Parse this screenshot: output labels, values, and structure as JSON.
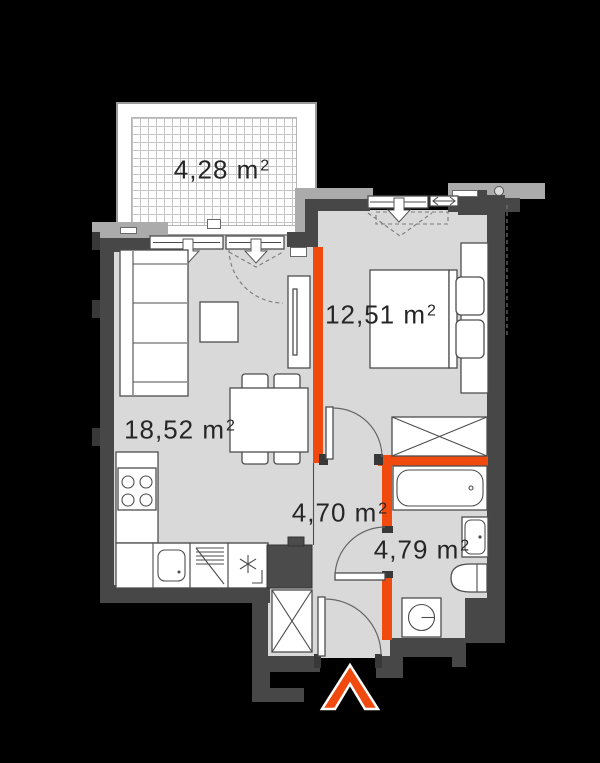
{
  "plan_type": "apartment-floor-plan",
  "rooms": [
    {
      "id": "living-kitchen",
      "area_label": "18,52 m",
      "sup": "2"
    },
    {
      "id": "bedroom",
      "area_label": "12,51 m",
      "sup": "2"
    },
    {
      "id": "balcony",
      "area_label": "4,28 m",
      "sup": "2"
    },
    {
      "id": "hallway",
      "area_label": "4,70 m",
      "sup": "2"
    },
    {
      "id": "bathroom",
      "area_label": "4,79 m",
      "sup": "2"
    }
  ],
  "colors": {
    "background": "#000000",
    "floor": "#D9D9D9",
    "wall_dark": "#474747",
    "wall_light": "#ABABAB",
    "accent_orange": "#F04A0F",
    "outline": "#4D4D4D",
    "label_text": "#262626",
    "balcony_grid": "#C4C4C4"
  },
  "symbols": [
    "sofa",
    "coffee-table",
    "tv-cabinet",
    "dining-table",
    "chair",
    "kitchen-counter",
    "cooktop",
    "kitchen-sink",
    "dishwasher",
    "appliance-asterisk",
    "bed",
    "pillow",
    "headboard-console",
    "wardrobe-x",
    "radiator",
    "bathtub",
    "washbasin",
    "toilet",
    "washing-machine",
    "shaft",
    "window",
    "down-arrow",
    "door-swing",
    "entrance-arrow"
  ],
  "entrance_marker": "entrance-arrow-up"
}
